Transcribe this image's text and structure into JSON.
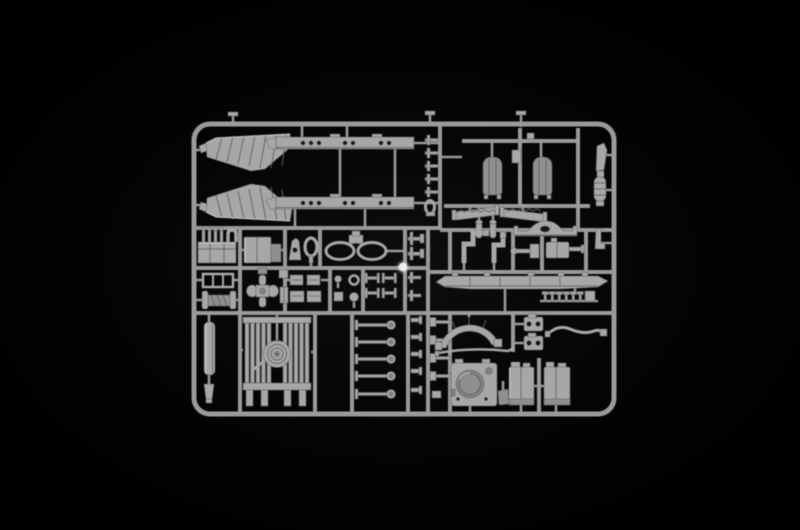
{
  "scene": {
    "description": "Light grey injection-moulded plastic model kit parts sprue photographed on a black background",
    "colors": {
      "bg_center": "#0d0d0d",
      "bg_edge": "#000000",
      "plastic": "#a7a7a5",
      "plastic_dim": "#8f8f8d",
      "plastic_hl": "#c9c9c7",
      "plastic_shadow": "#5f5f5d",
      "runner": "#9a9a98",
      "hole": "#141414",
      "recess": "#82827f",
      "bright_spot": "#f1f1ef"
    }
  },
  "sprue": {
    "part_groups": [
      {
        "id": "frame",
        "label": "sprue outer frame"
      },
      {
        "id": "runner-grid",
        "label": "runner grid"
      },
      {
        "id": "fenders",
        "label": "ribbed fender parts"
      },
      {
        "id": "chassis-rails",
        "label": "chassis rail parts"
      },
      {
        "id": "pin-parts",
        "label": "small pin parts"
      },
      {
        "id": "fuel-tanks",
        "label": "fuel tank parts"
      },
      {
        "id": "treads",
        "label": "serrated tread parts"
      },
      {
        "id": "axle",
        "label": "humped axle part"
      },
      {
        "id": "exhaust-stack",
        "label": "exhaust stack part"
      },
      {
        "id": "engine",
        "label": "engine block part"
      },
      {
        "id": "storage-box",
        "label": "storage box part"
      },
      {
        "id": "bracket",
        "label": "bracket part"
      },
      {
        "id": "shackle",
        "label": "tow shackle part"
      },
      {
        "id": "cable-coil",
        "label": "coiled cable part"
      },
      {
        "id": "bolt-pair",
        "label": "small bolt parts"
      },
      {
        "id": "elbow-pipes",
        "label": "elbow pipe parts"
      },
      {
        "id": "hammer",
        "label": "hammer-shaped part"
      },
      {
        "id": "gearbox",
        "label": "gearbox part"
      },
      {
        "id": "corner-part",
        "label": "corner bracket part"
      },
      {
        "id": "grille",
        "label": "grille frame part"
      },
      {
        "id": "winch",
        "label": "winch drum part"
      },
      {
        "id": "cross-joint",
        "label": "cross joint part"
      },
      {
        "id": "hatches",
        "label": "hatch panel parts"
      },
      {
        "id": "small-parts",
        "label": "assorted small parts"
      },
      {
        "id": "hubs",
        "label": "hub parts"
      },
      {
        "id": "driveshafts",
        "label": "drive shaft parts"
      },
      {
        "id": "hull-bar",
        "label": "long tapered rail part"
      },
      {
        "id": "studs",
        "label": "stud parts row"
      },
      {
        "id": "cylinder",
        "label": "cylinder part"
      },
      {
        "id": "radiator-fan",
        "label": "radiator with spiral fan"
      },
      {
        "id": "bolt-column",
        "label": "bolt parts column"
      },
      {
        "id": "bolt-column-2",
        "label": "second bolt parts column"
      },
      {
        "id": "tiny-column",
        "label": "tiny parts column"
      },
      {
        "id": "fender-arc",
        "label": "curved fender arc part"
      },
      {
        "id": "lever",
        "label": "thin lever part"
      },
      {
        "id": "hinge-brackets",
        "label": "hinge bracket parts"
      },
      {
        "id": "hose",
        "label": "curved hose part"
      },
      {
        "id": "mount-plate",
        "label": "mount plate with round opening"
      },
      {
        "id": "flap",
        "label": "small flap part"
      },
      {
        "id": "stowage-boxes",
        "label": "stowage box parts"
      },
      {
        "id": "bright-spot",
        "label": "specular highlight"
      }
    ]
  }
}
